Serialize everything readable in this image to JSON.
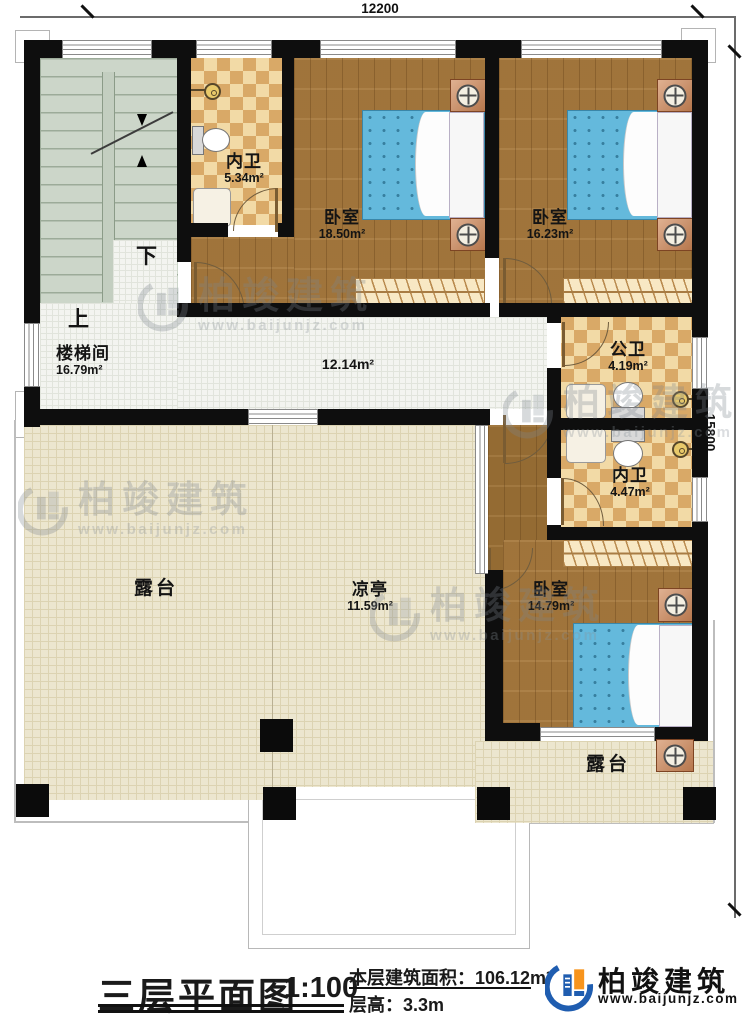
{
  "dimensions": {
    "top": "12200",
    "right": "15800"
  },
  "rooms": {
    "bath_top": {
      "name": "内卫",
      "area": "5.34m²"
    },
    "bedroom1": {
      "name": "卧室",
      "area": "18.50m²"
    },
    "bedroom2": {
      "name": "卧室",
      "area": "16.23m²"
    },
    "stairwell": {
      "name": "楼梯间",
      "area": "16.79m²"
    },
    "corridor": {
      "area": "12.14m²"
    },
    "public_bath": {
      "name": "公卫",
      "area": "4.19m²"
    },
    "bath_bottom": {
      "name": "内卫",
      "area": "4.47m²"
    },
    "bedroom3": {
      "name": "卧室",
      "area": "14.79m²"
    },
    "terrace_left": {
      "name": "露台"
    },
    "pavilion": {
      "name": "凉亭",
      "area": "11.59m²"
    },
    "terrace_right": {
      "name": "露台"
    }
  },
  "stairs": {
    "up": "上",
    "down": "下"
  },
  "watermark": {
    "brand": "柏竣建筑",
    "site": "www.baijunjz.com"
  },
  "title_block": {
    "title": "三层平面图",
    "scale": "1:100",
    "area_label": "本层建筑面积：",
    "area_value": "106.12m²",
    "height_label": "层高：",
    "height_value": "3.3m"
  },
  "brand": {
    "name": "柏竣建筑",
    "site": "www.baijunjz.com"
  },
  "colors": {
    "wall": "#0e0e0e",
    "wood_floor": "#a87a3e",
    "bath_tile_light": "#f2daa6",
    "bath_tile_dark": "#d9a967",
    "terrace": "#ece6cf",
    "bed_blue": "#64b9dc",
    "logo_blue": "#1f5db0",
    "logo_orange": "#f7941d"
  }
}
